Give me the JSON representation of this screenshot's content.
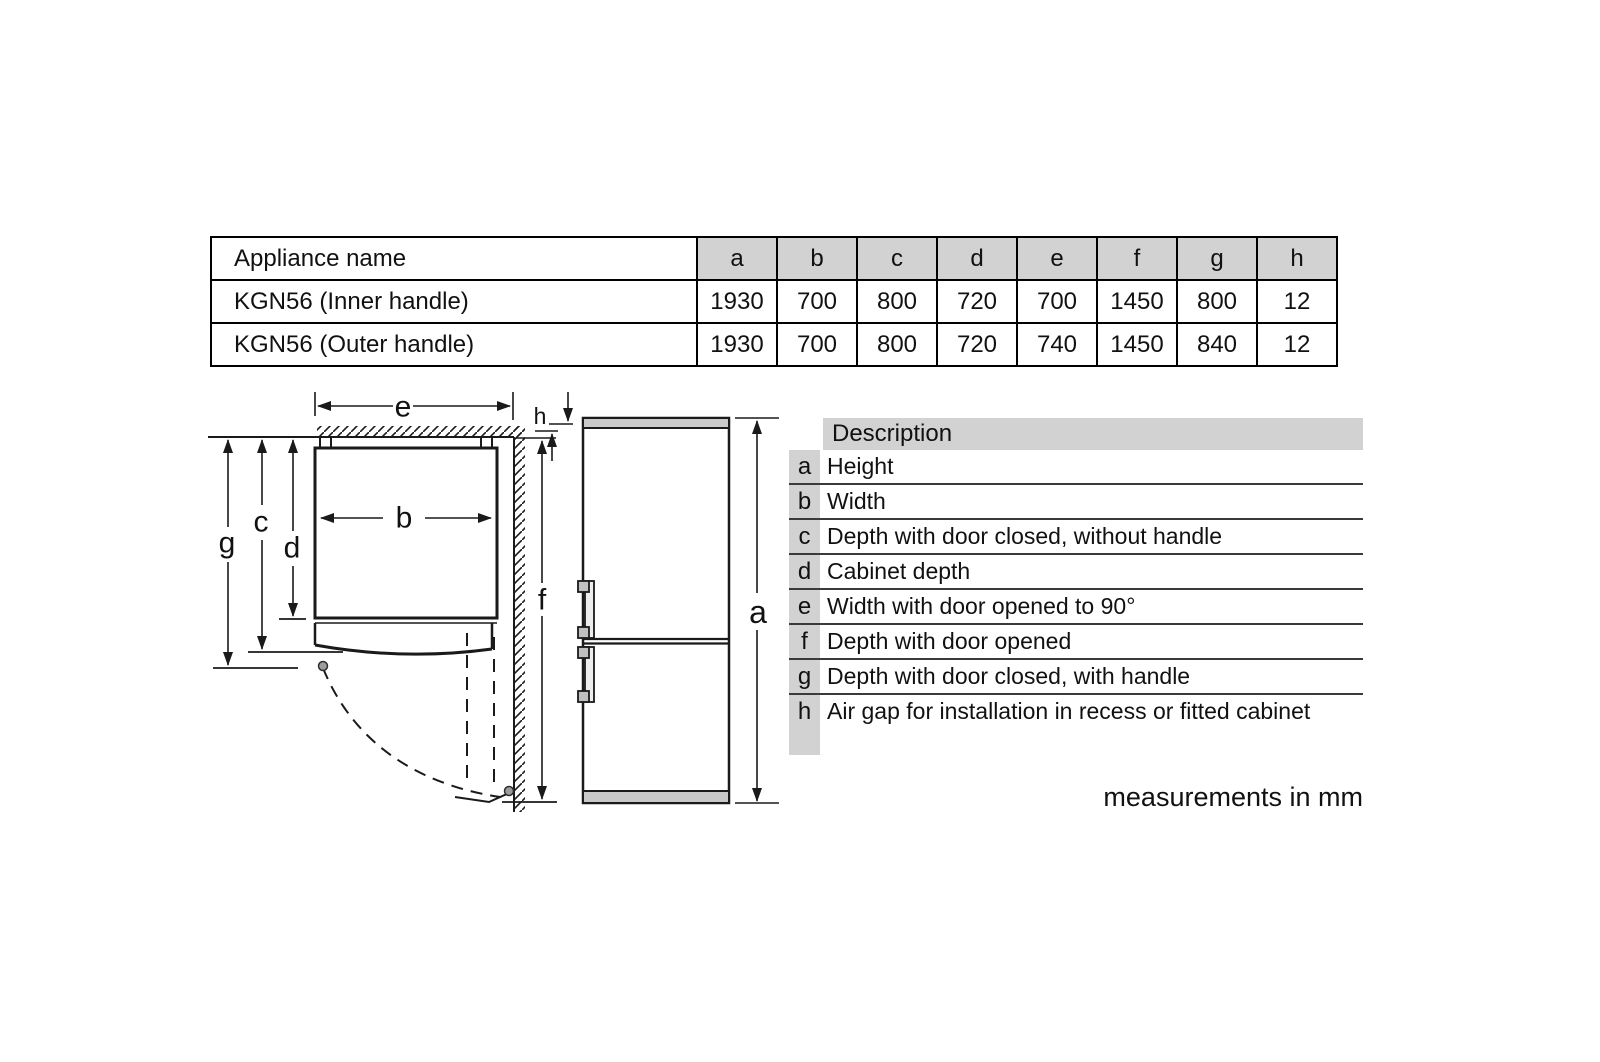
{
  "spec_table": {
    "header": [
      "Appliance name",
      "a",
      "b",
      "c",
      "d",
      "e",
      "f",
      "g",
      "h"
    ],
    "rows": [
      {
        "name": "KGN56 (Inner handle)",
        "values": [
          "1930",
          "700",
          "800",
          "720",
          "700",
          "1450",
          "800",
          "12"
        ]
      },
      {
        "name": "KGN56 (Outer handle)",
        "values": [
          "1930",
          "700",
          "800",
          "720",
          "740",
          "1450",
          "840",
          "12"
        ]
      }
    ]
  },
  "description_table": {
    "header": "Description",
    "rows": [
      {
        "key": "a",
        "text": "Height"
      },
      {
        "key": "b",
        "text": "Width"
      },
      {
        "key": "c",
        "text": "Depth with door closed, without handle"
      },
      {
        "key": "d",
        "text": "Cabinet depth"
      },
      {
        "key": "e",
        "text": "Width with door opened to 90°"
      },
      {
        "key": "f",
        "text": "Depth with door opened"
      },
      {
        "key": "g",
        "text": "Depth with door closed, with handle"
      },
      {
        "key": "h",
        "text": "Air gap for installation in recess or fitted cabinet"
      }
    ]
  },
  "diagram": {
    "labels": {
      "a": "a",
      "b": "b",
      "c": "c",
      "d": "d",
      "e": "e",
      "f": "f",
      "g": "g",
      "h": "h"
    }
  },
  "footnote": "measurements in mm",
  "colors": {
    "table_header_bg": "#d2d2d2",
    "appliance_trim_gray": "#c9c9c9",
    "line_black": "#1a1a1a"
  }
}
